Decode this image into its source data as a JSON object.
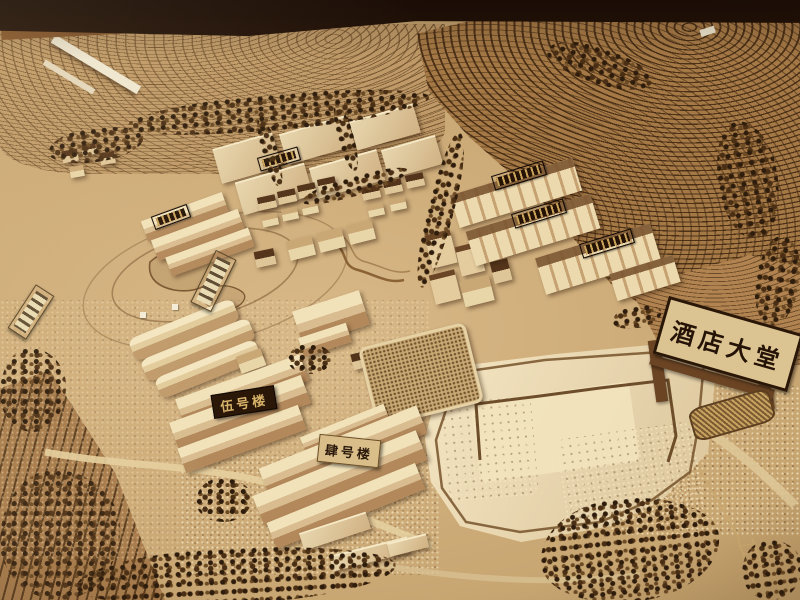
{
  "photo": {
    "signs": {
      "hotel_lobby": "酒店大堂",
      "building_5": "伍号楼",
      "building_4": "肆号楼"
    },
    "palette": {
      "table_dark": "#1c0e06",
      "floor_wood": "#8a5a2e",
      "terrain_light": "#d6b585",
      "terrain_mid": "#c7a571",
      "terrain_terrace": "#a57946",
      "contour_dark": "#5e3c1f",
      "building_wood": "#ecd9ae",
      "roof_dark": "#53341b",
      "plaque_dark": "#241305",
      "plaque_gold": "#caa45f",
      "sign_board": "#dcc492",
      "sign_text": "#241306",
      "tree_dark": "#2e1c0c",
      "plywood_plaza": "#ead9b1"
    }
  }
}
